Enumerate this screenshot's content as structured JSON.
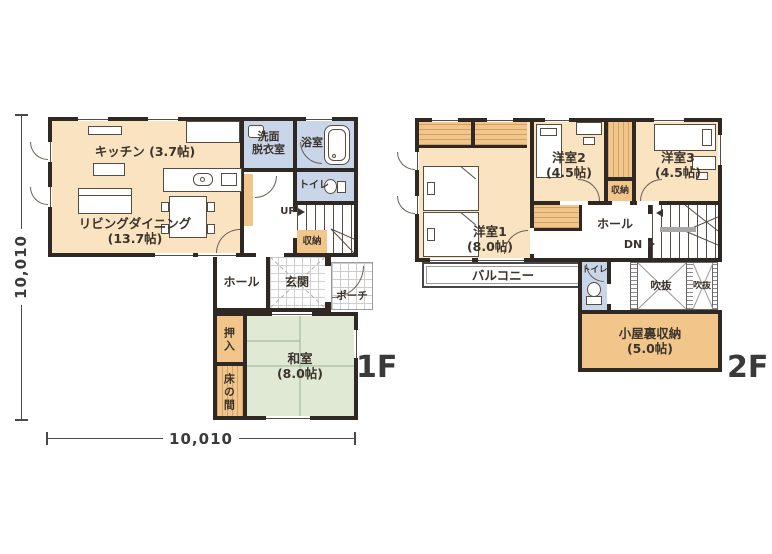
{
  "palette": {
    "room_cream": "#fae3c1",
    "room_green": "#dfe9d4",
    "room_blue": "#c9d5e8",
    "room_orange": "#f2c68a",
    "wall": "#2f2823"
  },
  "floor1": {
    "label": "1F",
    "dim_vertical": "10,010",
    "dim_horizontal": "10,010",
    "rooms": {
      "kitchen": {
        "name": "キッチン",
        "size": "(3.7帖)"
      },
      "living": {
        "name": "リビングダイニング",
        "size": "(13.7帖)"
      },
      "washroom": {
        "line1": "洗面",
        "line2": "脱衣室"
      },
      "bath": {
        "name": "浴室"
      },
      "toilet": {
        "name": "トイレ"
      },
      "storage": {
        "name": "収納"
      },
      "hall": {
        "name": "ホール"
      },
      "entrance": {
        "name": "玄関"
      },
      "porch": {
        "name": "ポーチ"
      },
      "closet": {
        "name": "押入"
      },
      "tokonoma": {
        "name": "床の間"
      },
      "tatami": {
        "name": "和室",
        "size": "(8.0帖)"
      }
    },
    "stairs": {
      "direction": "UP"
    }
  },
  "floor2": {
    "label": "2F",
    "rooms": {
      "bedroom1": {
        "name": "洋室1",
        "size": "(8.0帖)"
      },
      "bedroom2": {
        "name": "洋室2",
        "size": "(4.5帖)"
      },
      "bedroom3": {
        "name": "洋室3",
        "size": "(4.5帖)"
      },
      "storage": {
        "name": "収納"
      },
      "hall": {
        "name": "ホール"
      },
      "balcony": {
        "name": "バルコニー"
      },
      "toilet": {
        "name": "トイレ"
      },
      "void1": {
        "name": "吹抜"
      },
      "void2": {
        "name": "吹抜"
      },
      "attic": {
        "name": "小屋裏収納",
        "size": "(5.0帖)"
      }
    },
    "stairs": {
      "direction": "DN"
    }
  }
}
